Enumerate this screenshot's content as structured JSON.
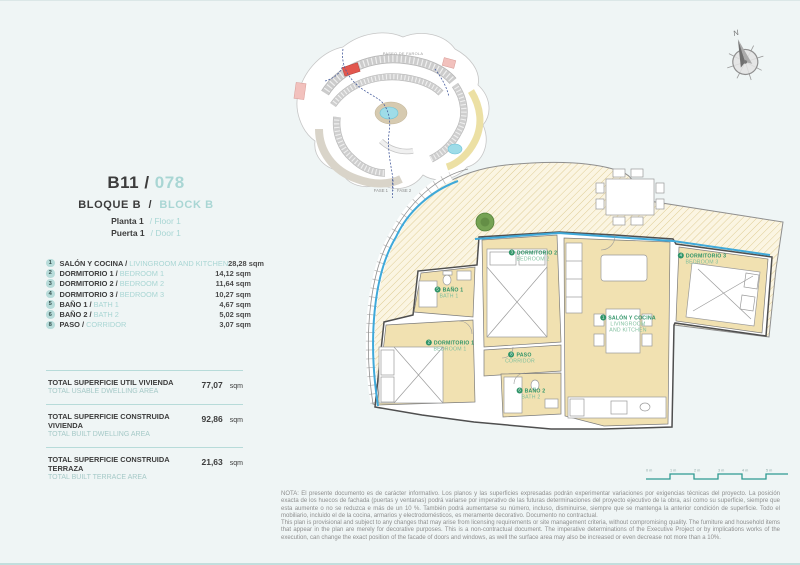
{
  "header": {
    "unit": "B11 /",
    "code": "078",
    "block_es": "BLOQUE B",
    "sep": "/",
    "block_en": "BLOCK B",
    "floor_es": "Planta 1",
    "floor_en": "/ Floor 1",
    "door_es": "Puerta 1",
    "door_en": "/ Door 1"
  },
  "legend": {
    "rooms": [
      {
        "num": "1",
        "name_es": "SALÓN Y COCINA /",
        "name_en": "LIVINGROOM AND KITCHEN",
        "area": "28,28 sqm"
      },
      {
        "num": "2",
        "name_es": "DORMITORIO 1 /",
        "name_en": "BEDROOM 1",
        "area": "14,12 sqm"
      },
      {
        "num": "3",
        "name_es": "DORMITORIO 2 /",
        "name_en": "BEDROOM 2",
        "area": "11,64 sqm"
      },
      {
        "num": "4",
        "name_es": "DORMITORIO 3 /",
        "name_en": "BEDROOM 3",
        "area": "10,27 sqm"
      },
      {
        "num": "5",
        "name_es": "BAÑO 1 /",
        "name_en": "BATH 1",
        "area": "4,67 sqm"
      },
      {
        "num": "6",
        "name_es": "BAÑO 2 /",
        "name_en": "BATH 2",
        "area": "5,02 sqm"
      },
      {
        "num": "8",
        "name_es": "PASO /",
        "name_en": "CORRIDOR",
        "area": "3,07 sqm"
      }
    ]
  },
  "totals": [
    {
      "label_es": "TOTAL SUPERFICIE UTIL VIVIENDA",
      "label_en": "TOTAL USABLE DWELLING AREA",
      "value": "77,07",
      "unit": "sqm"
    },
    {
      "label_es": "TOTAL SUPERFICIE CONSTRUIDA VIVIENDA",
      "label_en": "TOTAL BUILT DWELLING AREA",
      "value": "92,86",
      "unit": "sqm"
    },
    {
      "label_es": "TOTAL SUPERFICIE CONSTRUIDA TERRAZA",
      "label_en": "TOTAL BUILT TERRACE AREA",
      "value": "21,63",
      "unit": "sqm"
    }
  ],
  "plan": {
    "labels": [
      {
        "num": "1",
        "es": "SALÓN Y COCINA",
        "en": "LIVINGROOM AND KITCHEN"
      },
      {
        "num": "2",
        "es": "DORMITORIO 1",
        "en": "BEDROOM 1"
      },
      {
        "num": "3",
        "es": "DORMITORIO 2",
        "en": "BEDROOM 2"
      },
      {
        "num": "4",
        "es": "DORMITORIO 3",
        "en": "BEDROOM 3"
      },
      {
        "num": "5",
        "es": "BAÑO 1",
        "en": "BATH 1"
      },
      {
        "num": "6",
        "es": "BAÑO 2",
        "en": "BATH 2"
      },
      {
        "num": "8",
        "es": "PASO",
        "en": "CORRIDOR"
      }
    ]
  },
  "sitemap": {
    "area_label": "PASEO DE FAROLA",
    "phase1": "FASE 1",
    "phase2": "FASE 2"
  },
  "compass": {
    "north": "N"
  },
  "scalebar": {
    "labels": [
      "0 m",
      "1 m",
      "2 m",
      "3 m",
      "4 m",
      "5 m"
    ]
  },
  "note": {
    "es": "NOTA: El presente documento es de carácter informativo. Los planos y las superficies expresadas podrán experimentar variaciones por exigencias técnicas del proyecto. La posición exacta de los huecos de fachada (puertas y ventanas) podrá variarse por imperativo de las futuras determinaciones del proyecto ejecutivo de la obra, así como su superficie, siempre que esta aumente o no se reduzca e más de un 10 %. También podrá aumentarse su número, incluso, disminuirse, siempre que se mantenga la anterior condición de superficie. Todo el mobiliario, incluido el de la cocina, armarios y electrodomésticos, es meramente decorativo. Documento no contractual.",
    "en": "This plan is provisional and subject to any changes that may arise from licensing requirements or site management criteria, without compromising quality. The furniture and household items that appear in the plan are merely for decorative purposes. This is a non-contractual document. The imperative determinations of the Executive Project or by implications works of the execution, can change the exact position of the facade of doors and windows, as well the surface area may also be increased or even decrease not more than a 10%."
  }
}
